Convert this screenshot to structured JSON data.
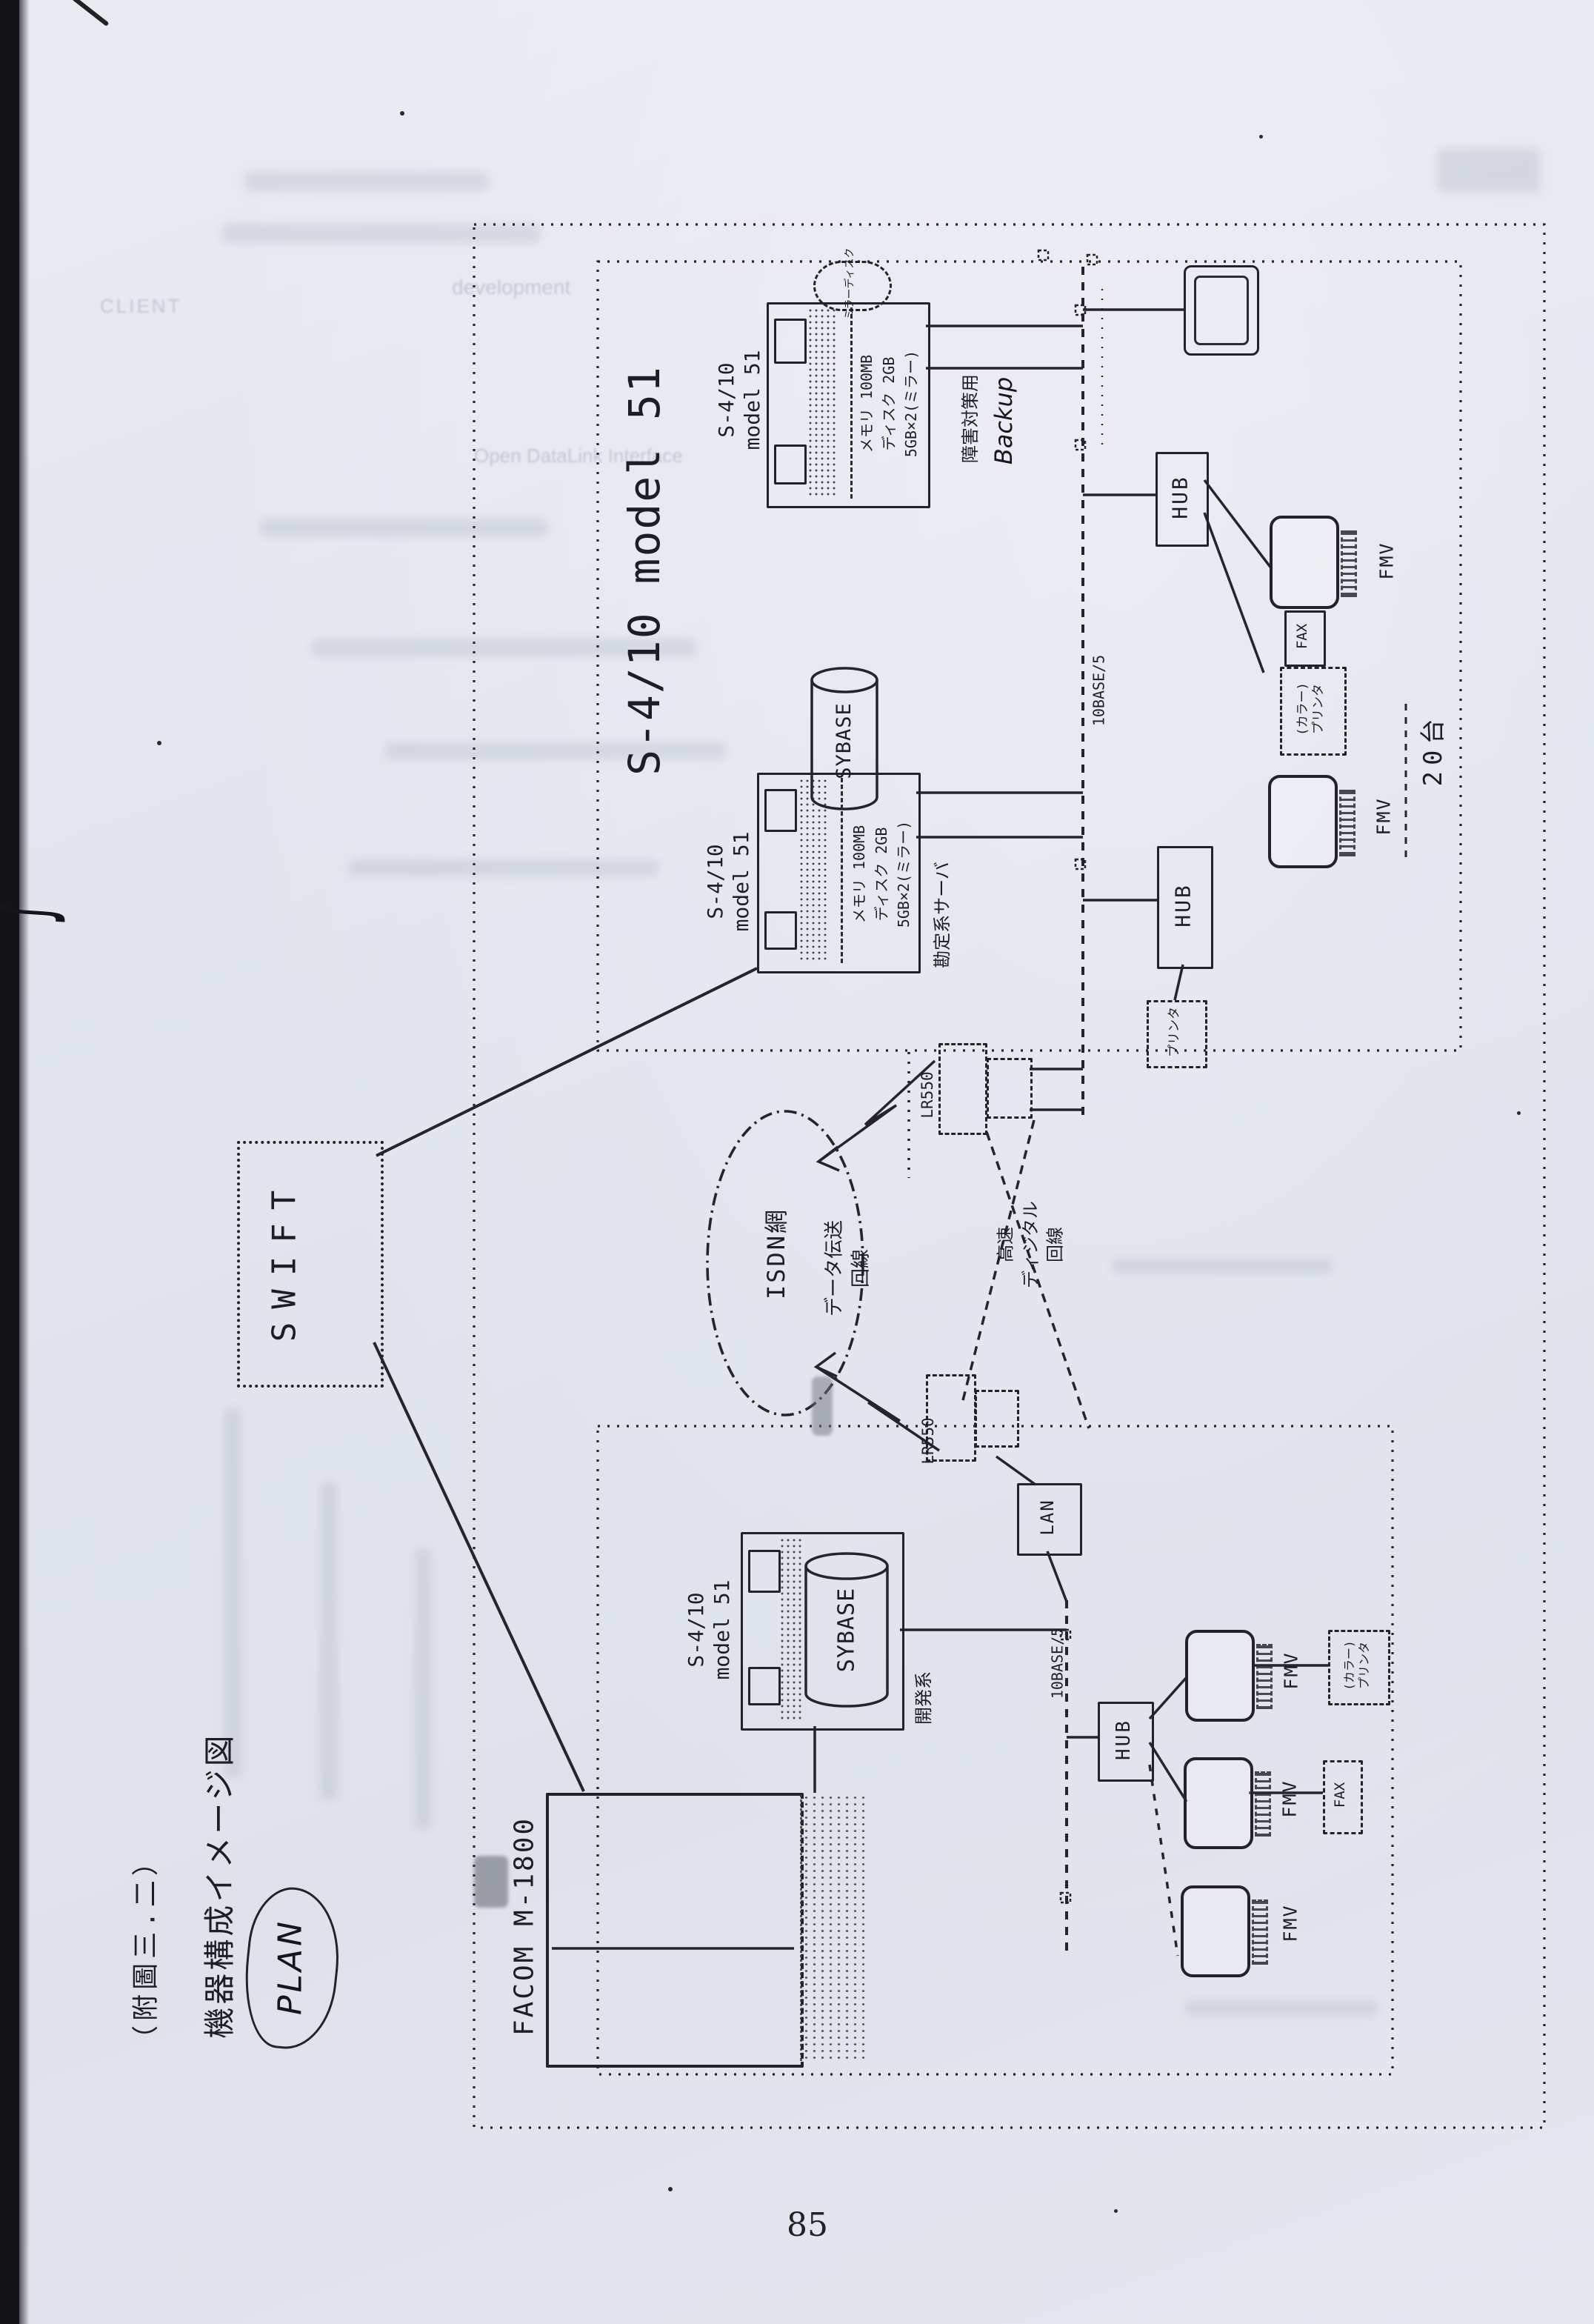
{
  "page": {
    "margin_title": "（附圖三.二）",
    "margin_subtitle": "機器構成イメージ図",
    "plan_note": "PLAN",
    "page_number": "85"
  },
  "external": {
    "swift_label": "SWIFT"
  },
  "cluster": {
    "heading": "S-4/10 model 51"
  },
  "servers": {
    "backup": {
      "label_line1": "S-4/10",
      "label_line2": "model 51",
      "spec_line1": "メモリ 100MB",
      "spec_line2": "ディスク 2GB",
      "spec_line3": "5GB×2(ミラー)",
      "callout": "ミラーディスク",
      "role_jp": "障害対策用",
      "role_en": "Backup"
    },
    "online": {
      "label_line1": "S-4/10",
      "label_line2": "model 51",
      "spec_line1": "メモリ 100MB",
      "spec_line2": "ディスク 2GB",
      "spec_line3": "5GB×2(ミラー)",
      "db": "SYBASE",
      "role_jp": "勘定系サーバ",
      "note_head_office": "head office",
      "note_branch": "branch"
    },
    "develop": {
      "label_line1": "S-4/10",
      "label_line2": "model 51",
      "db": "SYBASE",
      "role_jp": "開発系",
      "role_en": "Develop"
    }
  },
  "mainframe": {
    "label": "FACOM M-1800",
    "note": "Mainframe"
  },
  "network": {
    "isdn_label": "ISDN網",
    "router_upper": "LR550",
    "router_lower": "LR550",
    "line_label_1a": "データ伝送",
    "line_label_1b": "回線",
    "line_label_2a": "高速",
    "line_label_2b": "ディジタル",
    "line_label_2c": "回線",
    "lan_label": "LAN",
    "bus_label_upper": "10BASE/5",
    "bus_label_lower": "10BASE/5"
  },
  "clients_upper": {
    "hub1": "HUB",
    "hub2": "HUB",
    "fmv1": "FMV",
    "fmv2": "FMV",
    "fax": "FAX",
    "printer_line1": "(カラー)",
    "printer_line2": "プリンタ",
    "printer2": "プリンタ",
    "count": "20台",
    "os_note1": "AT compatible",
    "os_note2": "DOS/V",
    "os_note3": "Windows",
    "brace": "}"
  },
  "clients_lower": {
    "hub": "HUB",
    "fmv1": "FMV",
    "fmv2": "FMV",
    "fmv3": "FMV",
    "fax": "FAX",
    "printer_line1": "(カラー)",
    "printer_line2": "プリンタ"
  },
  "bleedthrough": {
    "fragment1": "CLIENT",
    "fragment2": "development",
    "fragment3": "Open DataLink Interface"
  }
}
